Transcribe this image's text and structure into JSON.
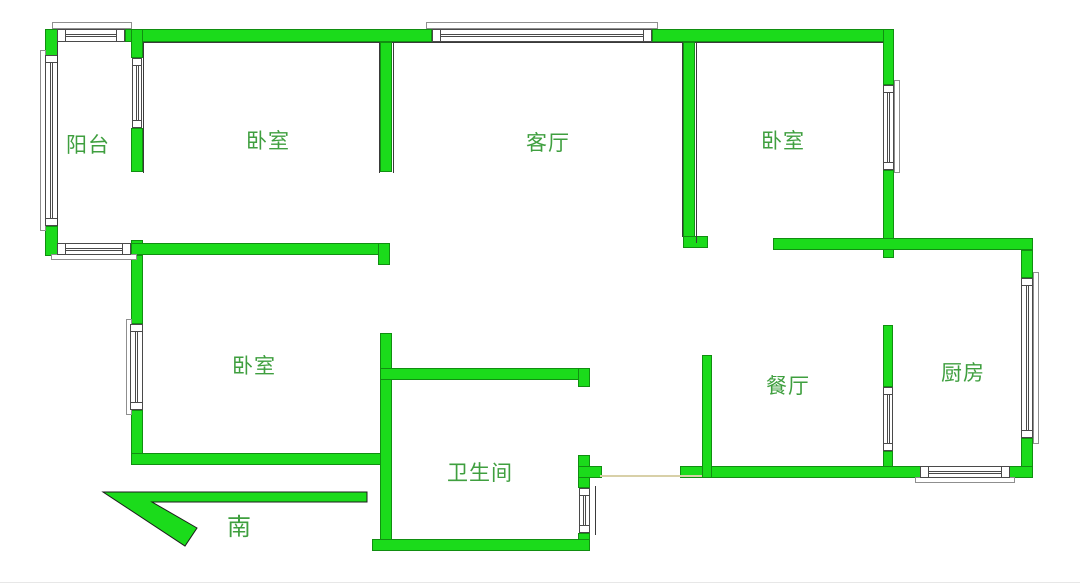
{
  "canvas": {
    "width": 1080,
    "height": 585
  },
  "colors": {
    "wall_green": "#1bdb1b",
    "label_green": "#3f9f3f",
    "window_border": "#4a4a4a",
    "sill_border": "#8f8f8f",
    "hairline": "#3a3a3a",
    "opening_line": "#d8d0a8",
    "arrow_outline": "#1b1b1b",
    "image_edge": "#e7e7e7"
  },
  "rooms": [
    {
      "id": "balcony",
      "label": "阳台",
      "x": 66,
      "y": 135,
      "size": 21
    },
    {
      "id": "bedroom-top",
      "label": "卧室",
      "x": 246,
      "y": 131,
      "size": 21
    },
    {
      "id": "living-room",
      "label": "客厅",
      "x": 526,
      "y": 133,
      "size": 21
    },
    {
      "id": "bedroom-right",
      "label": "卧室",
      "x": 761,
      "y": 131,
      "size": 21
    },
    {
      "id": "bedroom-middle",
      "label": "卧室",
      "x": 232,
      "y": 356,
      "size": 21
    },
    {
      "id": "dining-room",
      "label": "餐厅",
      "x": 766,
      "y": 376,
      "size": 21
    },
    {
      "id": "kitchen",
      "label": "厨房",
      "x": 941,
      "y": 363,
      "size": 21
    },
    {
      "id": "bathroom",
      "label": "卫生间",
      "x": 447,
      "y": 463,
      "size": 21
    }
  ],
  "compass": {
    "label": "南",
    "label_x": 227,
    "label_y": 516,
    "label_size": 24,
    "arrow_box": {
      "x": 95,
      "y": 484,
      "w": 290,
      "h": 72
    },
    "arrow_points": "8,8 272,8 272,18 57,18 102,44 90,62"
  },
  "walls": [
    [
      45,
      29,
      13,
      29
    ],
    [
      45,
      226,
      13,
      30
    ],
    [
      125,
      29,
      307,
      13
    ],
    [
      652,
      29,
      240,
      13
    ],
    [
      131,
      29,
      12,
      29
    ],
    [
      131,
      128,
      12,
      44
    ],
    [
      131,
      240,
      12,
      16
    ],
    [
      131,
      243,
      259,
      12
    ],
    [
      380,
      42,
      12,
      130
    ],
    [
      378,
      243,
      12,
      22
    ],
    [
      683,
      42,
      12,
      206
    ],
    [
      683,
      236,
      25,
      12
    ],
    [
      883,
      29,
      11,
      56
    ],
    [
      883,
      170,
      11,
      88
    ],
    [
      773,
      238,
      260,
      12
    ],
    [
      1021,
      250,
      12,
      28
    ],
    [
      1021,
      438,
      12,
      40
    ],
    [
      883,
      325,
      10,
      62
    ],
    [
      883,
      451,
      10,
      27
    ],
    [
      680,
      466,
      353,
      12
    ],
    [
      702,
      355,
      10,
      123
    ],
    [
      131,
      255,
      12,
      69
    ],
    [
      131,
      410,
      12,
      55
    ],
    [
      131,
      453,
      250,
      12
    ],
    [
      380,
      333,
      12,
      218
    ],
    [
      380,
      368,
      210,
      12
    ],
    [
      578,
      368,
      12,
      19
    ],
    [
      578,
      455,
      12,
      33
    ],
    [
      578,
      466,
      24,
      12
    ],
    [
      578,
      533,
      12,
      18
    ],
    [
      372,
      539,
      218,
      12
    ]
  ],
  "windows": [
    {
      "id": "balcony-top-window",
      "dir": "h",
      "band": [
        57,
        29,
        68,
        13
      ],
      "sill": [
        52,
        22,
        80,
        7
      ]
    },
    {
      "id": "living-top-window",
      "dir": "h",
      "band": [
        432,
        29,
        220,
        13
      ],
      "sill": [
        426,
        22,
        232,
        7
      ]
    },
    {
      "id": "balcony-left-window",
      "dir": "v",
      "band": [
        45,
        55,
        13,
        171
      ],
      "sill": [
        40,
        50,
        6,
        181
      ]
    },
    {
      "id": "balcony-divider-window",
      "dir": "v",
      "band": [
        132,
        58,
        10,
        70
      ],
      "sill": null
    },
    {
      "id": "bedroom-right-window",
      "dir": "v",
      "band": [
        883,
        85,
        11,
        85
      ],
      "sill": [
        894,
        80,
        6,
        93
      ]
    },
    {
      "id": "kitchen-right-window",
      "dir": "v",
      "band": [
        1021,
        278,
        12,
        160
      ],
      "sill": [
        1033,
        272,
        6,
        172
      ]
    },
    {
      "id": "kitchen-bottom-window",
      "dir": "h",
      "band": [
        920,
        466,
        90,
        12
      ],
      "sill": [
        915,
        477,
        100,
        6
      ]
    },
    {
      "id": "dining-divider-window",
      "dir": "v",
      "band": [
        883,
        387,
        10,
        64
      ],
      "sill": null
    },
    {
      "id": "bedroom3-left-window",
      "dir": "v",
      "band": [
        130,
        324,
        13,
        86
      ],
      "sill": [
        126,
        319,
        6,
        96
      ]
    },
    {
      "id": "balcony-bottom-window",
      "dir": "h",
      "band": [
        57,
        243,
        74,
        12
      ],
      "sill": [
        51,
        254,
        86,
        6
      ]
    },
    {
      "id": "bathroom-right-window",
      "dir": "v",
      "band": [
        579,
        488,
        11,
        45
      ],
      "sill": null
    }
  ],
  "hairlines": [
    {
      "rect": [
        143,
        42,
        237,
        1
      ],
      "c": "#3a3a3a"
    },
    {
      "rect": [
        392,
        42,
        291,
        1
      ],
      "c": "#3a3a3a"
    },
    {
      "rect": [
        695,
        42,
        188,
        1
      ],
      "c": "#3a3a3a"
    },
    {
      "rect": [
        57,
        42,
        1,
        184
      ],
      "c": "#3a3a3a"
    },
    {
      "rect": [
        143,
        42,
        1,
        131
      ],
      "c": "#3a3a3a"
    },
    {
      "rect": [
        379,
        42,
        1,
        131
      ],
      "c": "#3a3a3a"
    },
    {
      "rect": [
        393,
        42,
        1,
        131
      ],
      "c": "#3a3a3a"
    },
    {
      "rect": [
        682,
        42,
        1,
        195
      ],
      "c": "#3a3a3a"
    },
    {
      "rect": [
        696,
        42,
        1,
        201
      ],
      "c": "#3a3a3a"
    },
    {
      "rect": [
        595,
        486,
        1,
        49
      ],
      "c": "#3a3a3a"
    },
    {
      "rect": [
        0,
        582,
        1080,
        1
      ],
      "c": "#e7e7e7"
    }
  ],
  "opening_line": {
    "rect": [
      600,
      475,
      102,
      2
    ]
  }
}
